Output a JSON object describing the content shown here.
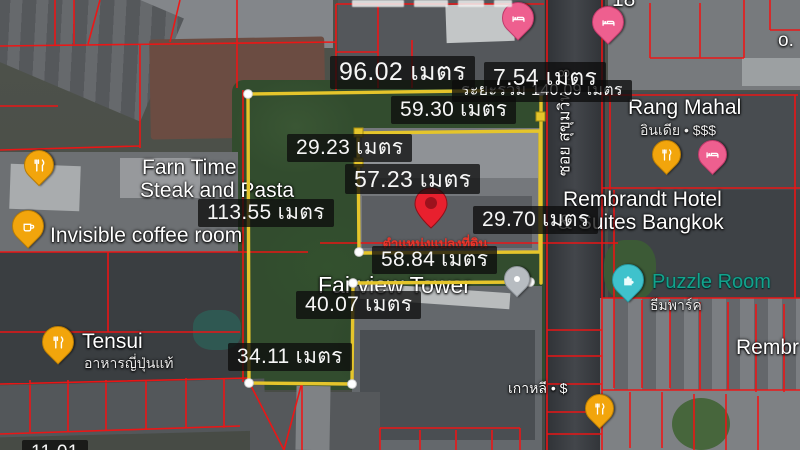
{
  "overlay": {
    "line_color": "#e5c52b",
    "parcel_line_color": "#f21313",
    "total_distance_label": "ระยะรวม 140.09 เมตร",
    "plot_marker_label": "ตำแหน่งแปลงที่ดิน",
    "unit": "เมตร",
    "measurements": [
      {
        "segment": "outer-top",
        "label": "96.02 เมตร"
      },
      {
        "segment": "outer-top-right",
        "label": "7.54 เมตร"
      },
      {
        "segment": "inner-top",
        "label": "59.30 เมตร"
      },
      {
        "segment": "inner-upper",
        "label": "29.23 เมตร"
      },
      {
        "segment": "inner-width",
        "label": "57.23 เมตร"
      },
      {
        "segment": "outer-left",
        "label": "113.55 เมตร"
      },
      {
        "segment": "outer-right",
        "label": "29.70 เมตร"
      },
      {
        "segment": "middle-width",
        "label": "58.84 เมตร"
      },
      {
        "segment": "notch-height",
        "label": "40.07 เมตร"
      },
      {
        "segment": "outer-bottom",
        "label": "34.11 เมตร"
      },
      {
        "segment": "bottom-clipped",
        "label": "11.01"
      }
    ]
  },
  "places": {
    "farn_time": {
      "line1": "Farn Time",
      "line2": "Steak and Pasta"
    },
    "invisible_coffee": {
      "name": "Invisible coffee room"
    },
    "tensui": {
      "name": "Tensui",
      "subtitle": "อาหารญี่ปุ่นแท้"
    },
    "rang_mahal": {
      "name": "Rang Mahal",
      "subtitle": "อินเดีย • $$$"
    },
    "rembrandt": {
      "line1": "Rembrandt Hotel",
      "line2": "& Suites Bangkok"
    },
    "puzzle_room": {
      "name": "Puzzle Room",
      "subtitle": "ธีมพาร์ค",
      "accent_color": "#12a38c"
    },
    "fairview_tower": {
      "name": "Fairview Tower"
    },
    "korean_restaurant": {
      "name": "เกาหลี • $"
    },
    "rembrandt_clipped": {
      "name": "Rembr"
    },
    "clipped_right_top": {
      "name": "o."
    },
    "clipped_top": {
      "name": "18"
    }
  },
  "street": {
    "label": "ซอย สุขุมวิท 18"
  }
}
